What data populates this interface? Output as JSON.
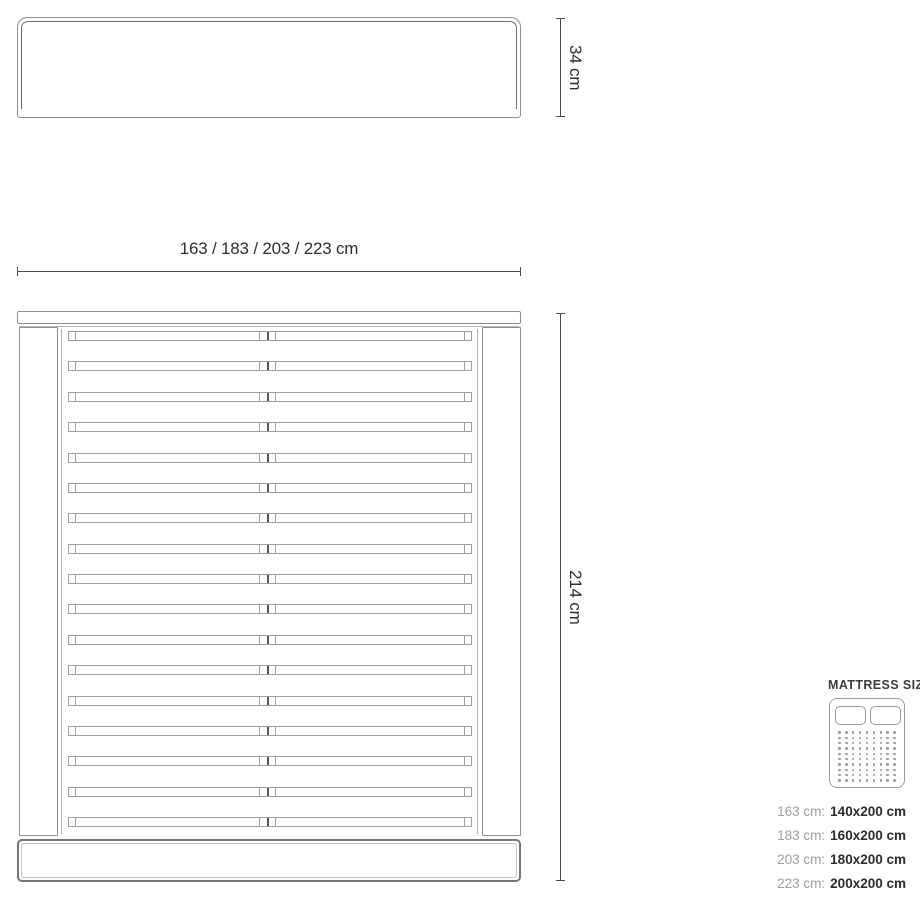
{
  "drawing": {
    "headboard_front_view": {
      "height_dimension": "34 cm"
    },
    "bed_top_view": {
      "width_dimension": "163 / 183 / 203 / 223 cm",
      "length_dimension": "214 cm",
      "slat_count": 17
    }
  },
  "mattress_legend": {
    "title": "MATTRESS SIZE",
    "icon": {
      "name": "double-mattress-icon",
      "pillow_count": 2,
      "dot_rows": 10,
      "dot_cols": 9
    },
    "sizes": [
      {
        "frame_width": "163 cm:",
        "mattress_size": "140x200 cm"
      },
      {
        "frame_width": "183 cm:",
        "mattress_size": "160x200 cm"
      },
      {
        "frame_width": "203 cm:",
        "mattress_size": "180x200 cm"
      },
      {
        "frame_width": "223 cm:",
        "mattress_size": "200x200 cm"
      }
    ]
  },
  "colors": {
    "background": "#ffffff",
    "outline": "#8f8f8f",
    "outline_dark": "#6e6e6e",
    "dimension_line": "#4a4a4a",
    "text_primary": "#2e2e2e",
    "text_muted": "#9e9e9e"
  }
}
